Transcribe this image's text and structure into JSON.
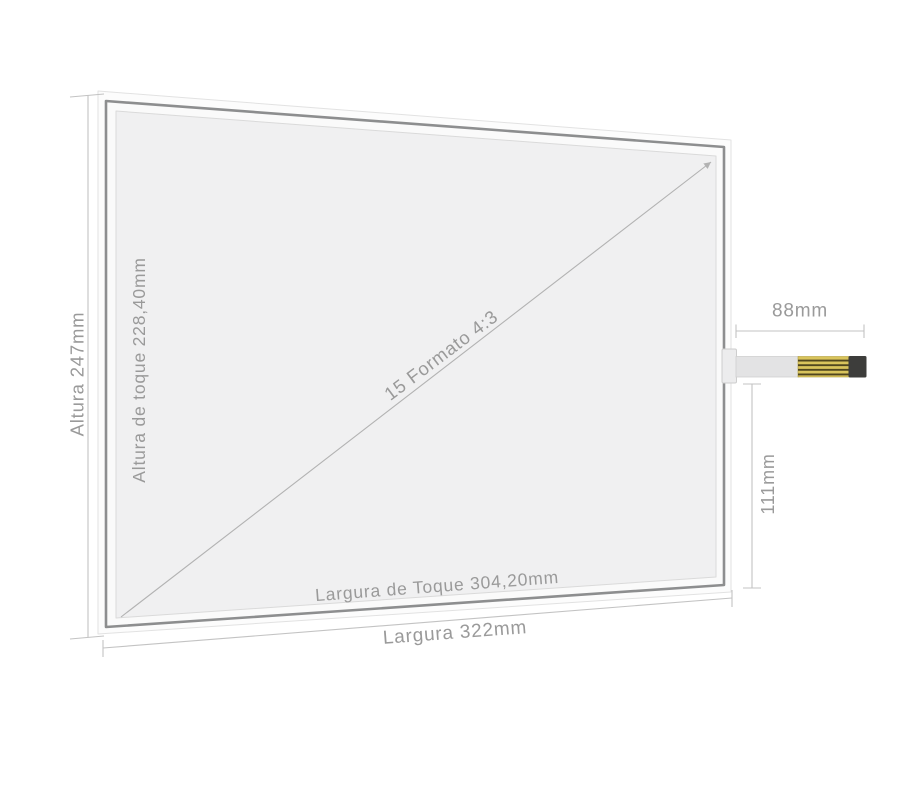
{
  "diagram": {
    "product": "touch-screen-panel",
    "labels": {
      "height_outer": "Altura 247mm",
      "height_touch": "Altura de toque 228,40mm",
      "diagonal": "15 Formato 4:3",
      "width_touch": "Largura de Toque 304,20mm",
      "width_outer": "Largura 322mm",
      "tail_length": "88mm",
      "tail_offset": "111mm"
    },
    "colors": {
      "background": "#ffffff",
      "panel_fill": "#f0f0f1",
      "panel_frame": "#8d8e8f",
      "glass_edge": "#e2e2e2",
      "inner_line": "#dadada",
      "dimension_line": "#c3c3c3",
      "label_text": "#9a9a9a",
      "cable_ribbon": "#e3e3e4",
      "cable_gold": "#d9c45c",
      "cable_gold_stripe": "#50461f",
      "cable_tip_black": "#3d3d3b"
    }
  }
}
